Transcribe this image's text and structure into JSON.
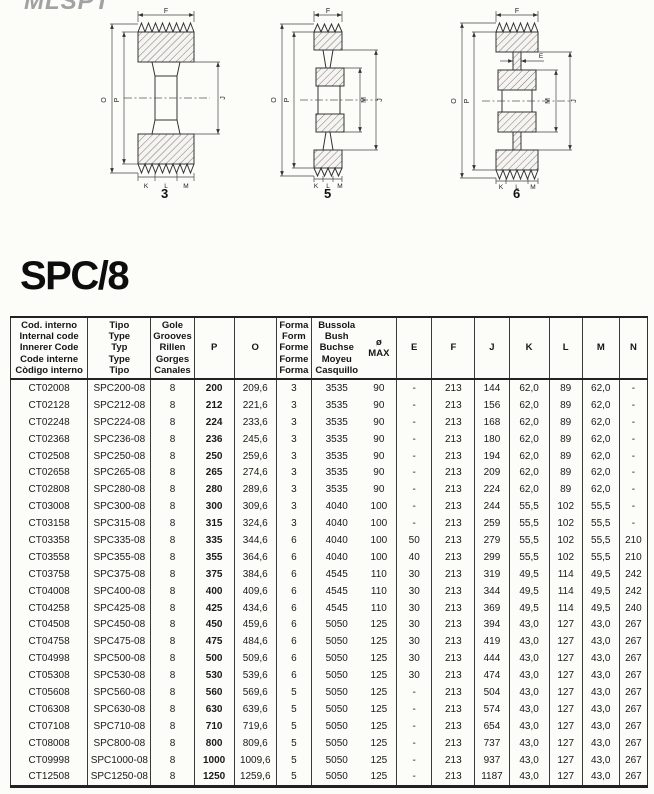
{
  "logo": {
    "text": "MLSPT"
  },
  "page_title": "SPC/8",
  "diagrams": [
    {
      "form": "3",
      "labels": {
        "top": "F",
        "left_outer": "O",
        "left_inner": "P",
        "right_outer": "J",
        "bottom_left": "K",
        "bottom_mid": "L",
        "bottom_right": "M"
      }
    },
    {
      "form": "5",
      "labels": {
        "top": "F",
        "left_outer": "O",
        "left_inner": "P",
        "right_inner": "M",
        "right_outer": "J",
        "bottom_left": "K",
        "bottom_mid": "L",
        "bottom_right": "M"
      }
    },
    {
      "form": "6",
      "labels": {
        "top": "F",
        "web": "E",
        "left_outer": "O",
        "left_inner": "P",
        "right_inner": "M",
        "right_outer": "J",
        "bottom_left": "K",
        "bottom_mid": "L",
        "bottom_right": "M"
      }
    }
  ],
  "table": {
    "headers": [
      "Cod. interno\nInternal code\nInnerer Code\nCode interne\nCòdigo interno",
      "Tipo\nType\nTyp\nType\nTipo",
      "Gole\nGrooves\nRillen\nGorges\nCanales",
      "P",
      "O",
      "Forma\nForm\nForme\nForme\nForma",
      "Bussola\nBush\nBuchse\nMoyeu\nCasquillo",
      "ø\nMAX",
      "E",
      "F",
      "J",
      "K",
      "L",
      "M",
      "N"
    ],
    "rows": [
      [
        "CT02008",
        "SPC200-08",
        "8",
        "200",
        "209,6",
        "3",
        "3535",
        "90",
        "-",
        "213",
        "144",
        "62,0",
        "89",
        "62,0",
        "-"
      ],
      [
        "CT02128",
        "SPC212-08",
        "8",
        "212",
        "221,6",
        "3",
        "3535",
        "90",
        "-",
        "213",
        "156",
        "62,0",
        "89",
        "62,0",
        "-"
      ],
      [
        "CT02248",
        "SPC224-08",
        "8",
        "224",
        "233,6",
        "3",
        "3535",
        "90",
        "-",
        "213",
        "168",
        "62,0",
        "89",
        "62,0",
        "-"
      ],
      [
        "CT02368",
        "SPC236-08",
        "8",
        "236",
        "245,6",
        "3",
        "3535",
        "90",
        "-",
        "213",
        "180",
        "62,0",
        "89",
        "62,0",
        "-"
      ],
      [
        "CT02508",
        "SPC250-08",
        "8",
        "250",
        "259,6",
        "3",
        "3535",
        "90",
        "-",
        "213",
        "194",
        "62,0",
        "89",
        "62,0",
        "-"
      ],
      [
        "CT02658",
        "SPC265-08",
        "8",
        "265",
        "274,6",
        "3",
        "3535",
        "90",
        "-",
        "213",
        "209",
        "62,0",
        "89",
        "62,0",
        "-"
      ],
      [
        "CT02808",
        "SPC280-08",
        "8",
        "280",
        "289,6",
        "3",
        "3535",
        "90",
        "-",
        "213",
        "224",
        "62,0",
        "89",
        "62,0",
        "-"
      ],
      [
        "CT03008",
        "SPC300-08",
        "8",
        "300",
        "309,6",
        "3",
        "4040",
        "100",
        "-",
        "213",
        "244",
        "55,5",
        "102",
        "55,5",
        "-"
      ],
      [
        "CT03158",
        "SPC315-08",
        "8",
        "315",
        "324,6",
        "3",
        "4040",
        "100",
        "-",
        "213",
        "259",
        "55,5",
        "102",
        "55,5",
        "-"
      ],
      [
        "CT03358",
        "SPC335-08",
        "8",
        "335",
        "344,6",
        "6",
        "4040",
        "100",
        "50",
        "213",
        "279",
        "55,5",
        "102",
        "55,5",
        "210"
      ],
      [
        "CT03558",
        "SPC355-08",
        "8",
        "355",
        "364,6",
        "6",
        "4040",
        "100",
        "40",
        "213",
        "299",
        "55,5",
        "102",
        "55,5",
        "210"
      ],
      [
        "CT03758",
        "SPC375-08",
        "8",
        "375",
        "384,6",
        "6",
        "4545",
        "110",
        "30",
        "213",
        "319",
        "49,5",
        "114",
        "49,5",
        "242"
      ],
      [
        "CT04008",
        "SPC400-08",
        "8",
        "400",
        "409,6",
        "6",
        "4545",
        "110",
        "30",
        "213",
        "344",
        "49,5",
        "114",
        "49,5",
        "242"
      ],
      [
        "CT04258",
        "SPC425-08",
        "8",
        "425",
        "434,6",
        "6",
        "4545",
        "110",
        "30",
        "213",
        "369",
        "49,5",
        "114",
        "49,5",
        "240"
      ],
      [
        "CT04508",
        "SPC450-08",
        "8",
        "450",
        "459,6",
        "6",
        "5050",
        "125",
        "30",
        "213",
        "394",
        "43,0",
        "127",
        "43,0",
        "267"
      ],
      [
        "CT04758",
        "SPC475-08",
        "8",
        "475",
        "484,6",
        "6",
        "5050",
        "125",
        "30",
        "213",
        "419",
        "43,0",
        "127",
        "43,0",
        "267"
      ],
      [
        "CT04998",
        "SPC500-08",
        "8",
        "500",
        "509,6",
        "6",
        "5050",
        "125",
        "30",
        "213",
        "444",
        "43,0",
        "127",
        "43,0",
        "267"
      ],
      [
        "CT05308",
        "SPC530-08",
        "8",
        "530",
        "539,6",
        "6",
        "5050",
        "125",
        "30",
        "213",
        "474",
        "43,0",
        "127",
        "43,0",
        "267"
      ],
      [
        "CT05608",
        "SPC560-08",
        "8",
        "560",
        "569,6",
        "5",
        "5050",
        "125",
        "-",
        "213",
        "504",
        "43,0",
        "127",
        "43,0",
        "267"
      ],
      [
        "CT06308",
        "SPC630-08",
        "8",
        "630",
        "639,6",
        "5",
        "5050",
        "125",
        "-",
        "213",
        "574",
        "43,0",
        "127",
        "43,0",
        "267"
      ],
      [
        "CT07108",
        "SPC710-08",
        "8",
        "710",
        "719,6",
        "5",
        "5050",
        "125",
        "-",
        "213",
        "654",
        "43,0",
        "127",
        "43,0",
        "267"
      ],
      [
        "CT08008",
        "SPC800-08",
        "8",
        "800",
        "809,6",
        "5",
        "5050",
        "125",
        "-",
        "213",
        "737",
        "43,0",
        "127",
        "43,0",
        "267"
      ],
      [
        "CT09998",
        "SPC1000-08",
        "8",
        "1000",
        "1009,6",
        "5",
        "5050",
        "125",
        "-",
        "213",
        "937",
        "43,0",
        "127",
        "43,0",
        "267"
      ],
      [
        "CT12508",
        "SPC1250-08",
        "8",
        "1250",
        "1259,6",
        "5",
        "5050",
        "125",
        "-",
        "213",
        "1187",
        "43,0",
        "127",
        "43,0",
        "267"
      ]
    ]
  }
}
